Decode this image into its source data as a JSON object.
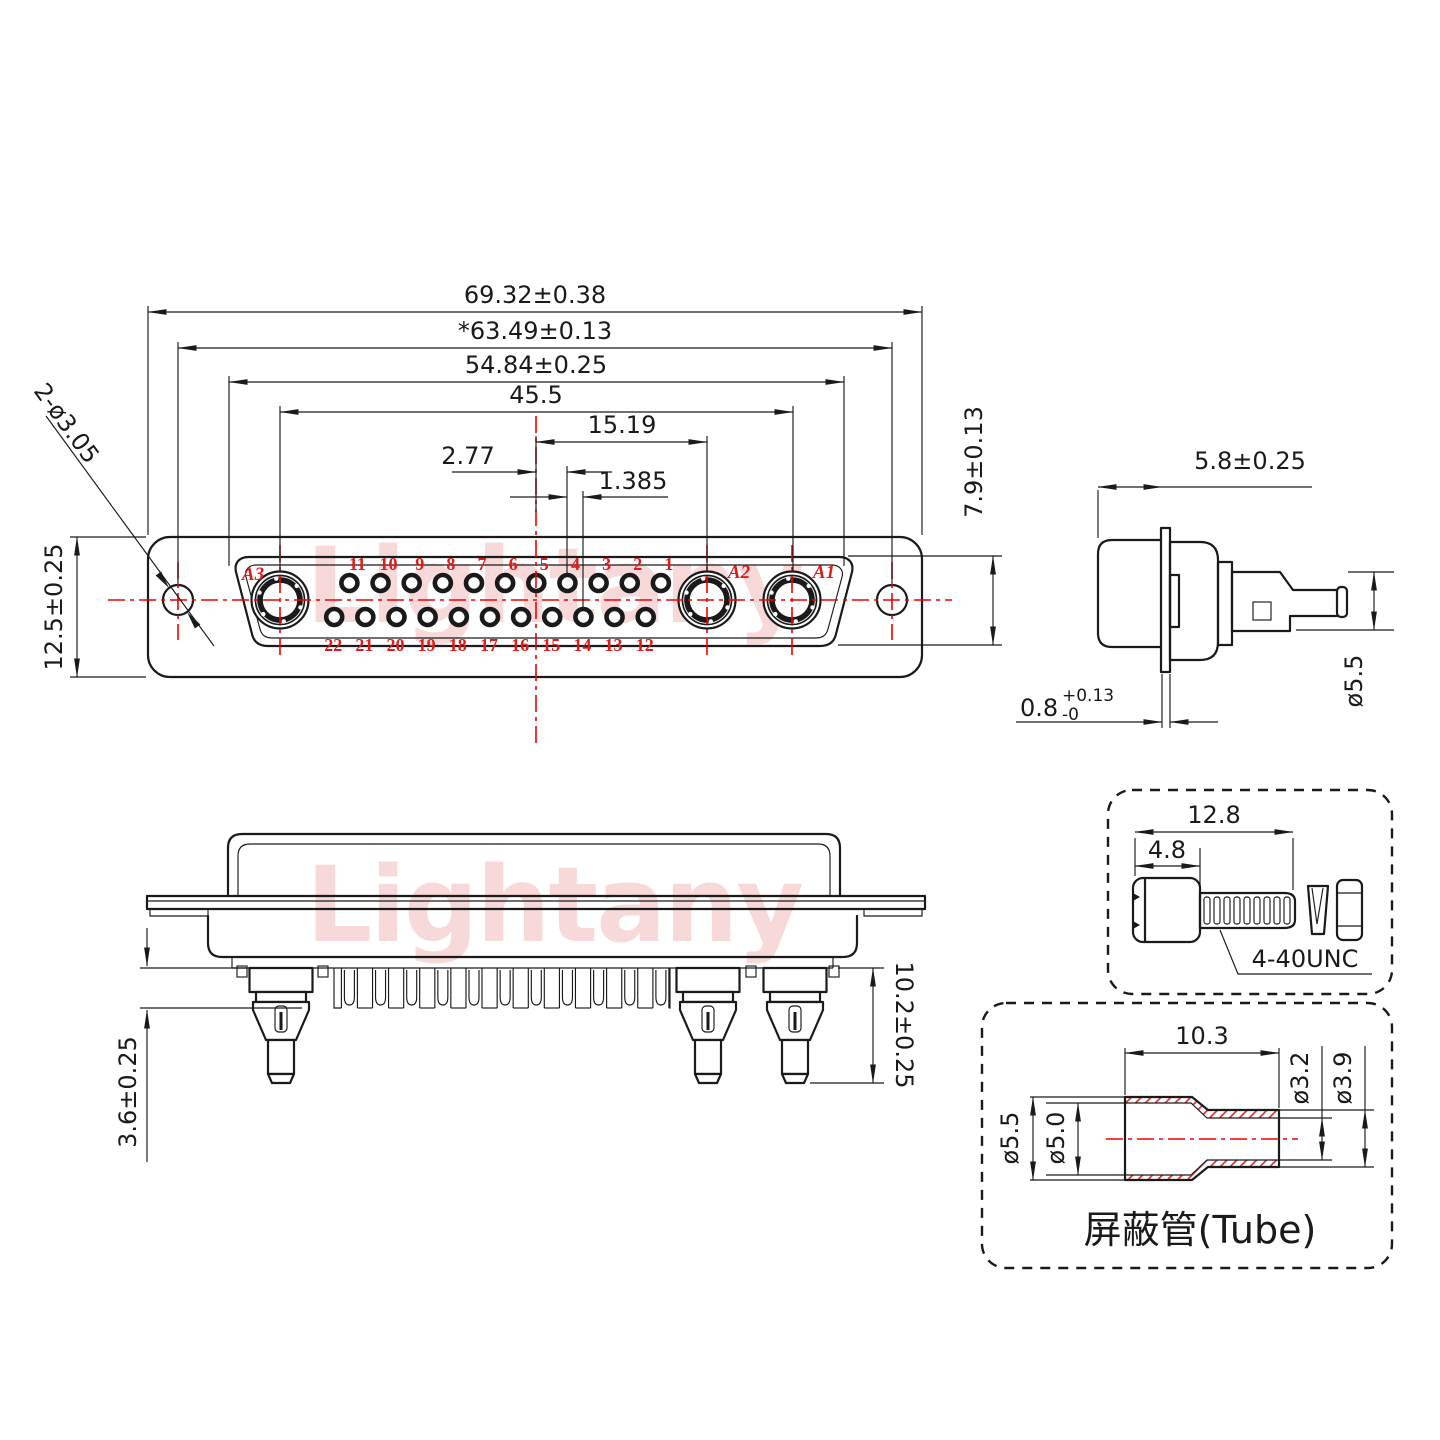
{
  "watermark": "Lightany",
  "colors": {
    "red": "#f20000",
    "label_red": "#e01b1b",
    "watermark_pink": "#f8d9d9",
    "line": "#1a1a1a"
  },
  "front_view": {
    "dims": {
      "overall_width": "69.32±0.38",
      "hole_span": "*63.49±0.13",
      "cutout_width": "54.84±0.25",
      "coax_span": "45.5",
      "pin_to_coax": "15.19",
      "pin_pitch": "2.77",
      "row_offset": "1.385",
      "body_height": "12.5±0.25",
      "cutout_height": "7.9±0.13",
      "mount_holes": "2-ø3.05"
    },
    "pins": {
      "top_row": [
        "11",
        "10",
        "9",
        "8",
        "7",
        "6",
        "5",
        "4",
        "3",
        "2",
        "1"
      ],
      "bottom_row": [
        "22",
        "21",
        "20",
        "19",
        "18",
        "17",
        "16",
        "15",
        "14",
        "13",
        "12"
      ],
      "coax": [
        "A3",
        "A2",
        "A1"
      ]
    }
  },
  "side_view": {
    "dims": {
      "front_depth": "5.8±0.25",
      "barrel_dia": "ø5.5",
      "flange_thickness": "0.8",
      "tol_plus": "+0.13",
      "tol_minus": "-0"
    }
  },
  "section_view": {
    "dims": {
      "standoff": "3.6±0.25",
      "pin_length": "10.2±0.25"
    }
  },
  "screw_detail": {
    "dims": {
      "total_length": "12.8",
      "head_length": "4.8"
    },
    "thread_label": "4-40UNC"
  },
  "tube_detail": {
    "dims": {
      "body_length": "10.3",
      "small_inner_dia": "ø3.2",
      "small_outer_dia": "ø3.9",
      "large_outer_dia": "ø5.5",
      "large_inner_dia": "ø5.0"
    },
    "label": "屏蔽管(Tube)"
  }
}
